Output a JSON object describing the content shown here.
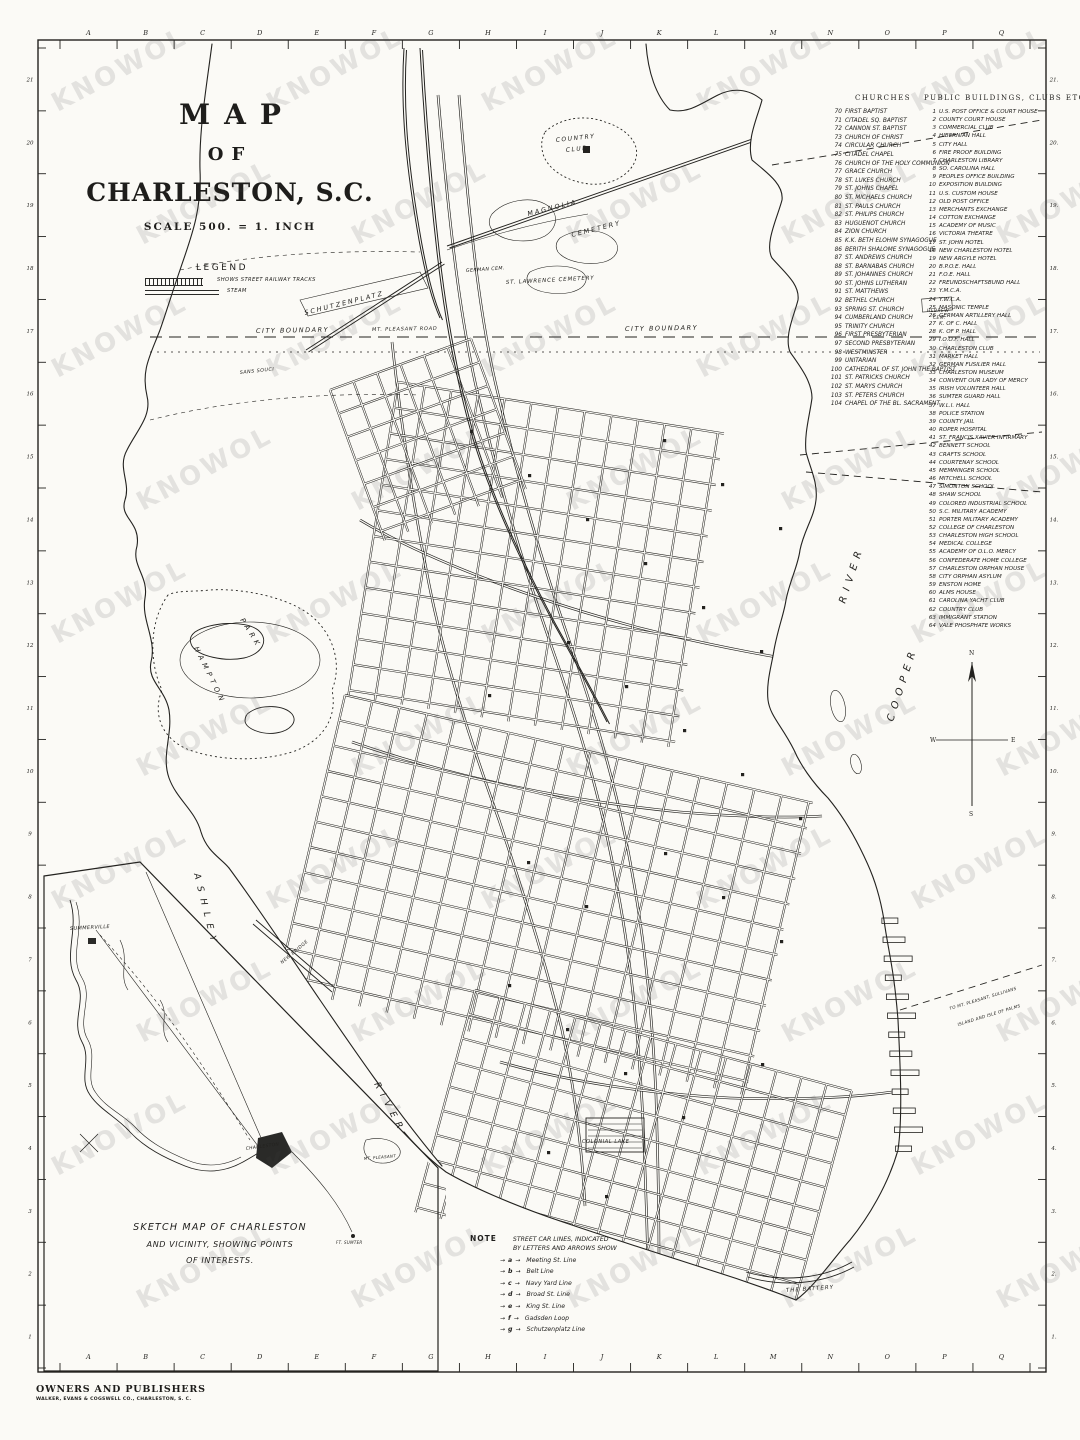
{
  "page": {
    "watermark": "KNOWOL"
  },
  "title": {
    "line1": "MAP",
    "line2": "OF",
    "line3": "CHARLESTON, S.C.",
    "scale": "SCALE 500. = 1. INCH"
  },
  "legend": {
    "heading": "LEGEND",
    "items": [
      {
        "symbol": "hatched-bar",
        "label": "SHOWS STREET RAILWAY TRACKS"
      },
      {
        "symbol": "double-line",
        "label": "STEAM"
      }
    ]
  },
  "ruler": {
    "letters": [
      "A",
      "B",
      "C",
      "D",
      "E",
      "F",
      "G",
      "H",
      "I",
      "J",
      "K",
      "L",
      "M",
      "N",
      "O",
      "P",
      "Q"
    ],
    "left_numbers": [
      "21",
      "20",
      "19",
      "18",
      "17",
      "16",
      "15",
      "14",
      "13",
      "12",
      "11",
      "10",
      "9",
      "8",
      "7",
      "6",
      "5",
      "4",
      "3",
      "2",
      "1"
    ],
    "right_numbers": [
      "21.",
      "20.",
      "19.",
      "18.",
      "17.",
      "16.",
      "15.",
      "14.",
      "13.",
      "12.",
      "11.",
      "10.",
      "9.",
      "8.",
      "7.",
      "6.",
      "5.",
      "4.",
      "3.",
      "2.",
      "1."
    ]
  },
  "churches": {
    "header": "CHURCHES",
    "items": [
      {
        "n": 70,
        "name": "FIRST BAPTIST"
      },
      {
        "n": 71,
        "name": "CITADEL SQ. BAPTIST"
      },
      {
        "n": 72,
        "name": "CANNON ST. BAPTIST"
      },
      {
        "n": 73,
        "name": "CHURCH OF CHRIST"
      },
      {
        "n": 74,
        "name": "CIRCULAR CHURCH"
      },
      {
        "n": 75,
        "name": "CITADEL CHAPEL"
      },
      {
        "n": 76,
        "name": "CHURCH OF THE HOLY COMMUNION"
      },
      {
        "n": 77,
        "name": "GRACE CHURCH"
      },
      {
        "n": 78,
        "name": "ST. LUKES CHURCH"
      },
      {
        "n": 79,
        "name": "ST. JOHNS CHAPEL"
      },
      {
        "n": 80,
        "name": "ST. MICHAELS CHURCH"
      },
      {
        "n": 81,
        "name": "ST. PAULS CHURCH"
      },
      {
        "n": 82,
        "name": "ST. PHILIPS CHURCH"
      },
      {
        "n": 83,
        "name": "HUGUENOT CHURCH"
      },
      {
        "n": 84,
        "name": "ZION CHURCH"
      },
      {
        "n": 85,
        "name": "K.K. BETH ELOHIM SYNAGOGUE"
      },
      {
        "n": 86,
        "name": "BERITH SHALOME SYNAGOGUE"
      },
      {
        "n": 87,
        "name": "ST. ANDREWS CHURCH"
      },
      {
        "n": 88,
        "name": "ST. BARNABAS CHURCH"
      },
      {
        "n": 89,
        "name": "ST. JOHANNES CHURCH"
      },
      {
        "n": 90,
        "name": "ST. JOHNS LUTHERAN"
      },
      {
        "n": 91,
        "name": "ST. MATTHEWS"
      },
      {
        "n": 92,
        "name": "BETHEL CHURCH"
      },
      {
        "n": 93,
        "name": "SPRING ST. CHURCH"
      },
      {
        "n": 94,
        "name": "CUMBERLAND CHURCH"
      },
      {
        "n": 95,
        "name": "TRINITY CHURCH"
      },
      {
        "n": 96,
        "name": "FIRST PRESBYTERIAN"
      },
      {
        "n": 97,
        "name": "SECOND PRESBYTERIAN"
      },
      {
        "n": 98,
        "name": "WESTMINSTER"
      },
      {
        "n": 99,
        "name": "UNITARIAN"
      },
      {
        "n": 100,
        "name": "CATHEDRAL OF ST. JOHN THE BAPTIST"
      },
      {
        "n": 101,
        "name": "ST. PATRICKS CHURCH"
      },
      {
        "n": 102,
        "name": "ST. MARYS CHURCH"
      },
      {
        "n": 103,
        "name": "ST. PETERS CHURCH"
      },
      {
        "n": 104,
        "name": "CHAPEL OF THE BL. SACRAMENT"
      }
    ]
  },
  "buildings": {
    "header": "PUBLIC BUILDINGS, CLUBS ETC.",
    "items": [
      {
        "n": 1,
        "name": "U.S. POST OFFICE & COURT HOUSE"
      },
      {
        "n": 2,
        "name": "COUNTY COURT HOUSE"
      },
      {
        "n": 3,
        "name": "COMMERCIAL CLUB"
      },
      {
        "n": 4,
        "name": "HIBERNIAN HALL"
      },
      {
        "n": 5,
        "name": "CITY HALL"
      },
      {
        "n": 6,
        "name": "FIRE PROOF BUILDING"
      },
      {
        "n": 7,
        "name": "CHARLESTON LIBRARY"
      },
      {
        "n": 8,
        "name": "SO. CAROLINA HALL"
      },
      {
        "n": 9,
        "name": "PEOPLES OFFICE BUILDING"
      },
      {
        "n": 10,
        "name": "EXPOSITION BUILDING"
      },
      {
        "n": 11,
        "name": "U.S. CUSTOM HOUSE"
      },
      {
        "n": 12,
        "name": "OLD POST OFFICE"
      },
      {
        "n": 13,
        "name": "MERCHANTS EXCHANGE"
      },
      {
        "n": 14,
        "name": "COTTON EXCHANGE"
      },
      {
        "n": 15,
        "name": "ACADEMY OF MUSIC"
      },
      {
        "n": 16,
        "name": "VICTORIA THEATRE"
      },
      {
        "n": 17,
        "name": "ST. JOHN HOTEL"
      },
      {
        "n": 18,
        "name": "NEW CHARLESTON HOTEL"
      },
      {
        "n": 19,
        "name": "NEW ARGYLE HOTEL"
      },
      {
        "n": 20,
        "name": "B.P.O.E. HALL"
      },
      {
        "n": 21,
        "name": "F.O.E. HALL"
      },
      {
        "n": 22,
        "name": "FREUNDSCHAFTSBUND HALL"
      },
      {
        "n": 23,
        "name": "Y.M.C.A."
      },
      {
        "n": 24,
        "name": "Y.W.C.A."
      },
      {
        "n": 25,
        "name": "MASONIC TEMPLE"
      },
      {
        "n": 26,
        "name": "GERMAN ARTILLERY HALL"
      },
      {
        "n": 27,
        "name": "K. OF C. HALL"
      },
      {
        "n": 28,
        "name": "K. OF P. HALL"
      },
      {
        "n": 29,
        "name": "I.O.O.F. HALL"
      },
      {
        "n": 30,
        "name": "CHARLESTON CLUB"
      },
      {
        "n": 31,
        "name": "MARKET HALL"
      },
      {
        "n": 32,
        "name": "GERMAN FUSILIER HALL"
      },
      {
        "n": 33,
        "name": "CHARLESTON MUSEUM"
      },
      {
        "n": 34,
        "name": "CONVENT OUR LADY OF MERCY"
      },
      {
        "n": 35,
        "name": "IRISH VOLUNTEER HALL"
      },
      {
        "n": 36,
        "name": "SUMTER GUARD HALL"
      },
      {
        "n": 37,
        "name": "W.L.I. HALL"
      },
      {
        "n": 38,
        "name": "POLICE STATION"
      },
      {
        "n": 39,
        "name": "COUNTY JAIL"
      },
      {
        "n": 40,
        "name": "ROPER HOSPITAL"
      },
      {
        "n": 41,
        "name": "ST. FRANCIS XAVIER INFIRMARY"
      },
      {
        "n": 42,
        "name": "BENNETT SCHOOL"
      },
      {
        "n": 43,
        "name": "CRAFTS SCHOOL"
      },
      {
        "n": 44,
        "name": "COURTENAY SCHOOL"
      },
      {
        "n": 45,
        "name": "MEMMINGER SCHOOL"
      },
      {
        "n": 46,
        "name": "MITCHELL SCHOOL"
      },
      {
        "n": 47,
        "name": "SIMONTON SCHOOL"
      },
      {
        "n": 48,
        "name": "SHAW SCHOOL"
      },
      {
        "n": 49,
        "name": "COLORED INDUSTRIAL SCHOOL"
      },
      {
        "n": 50,
        "name": "S.C. MILITARY ACADEMY"
      },
      {
        "n": 51,
        "name": "PORTER MILITARY ACADEMY"
      },
      {
        "n": 52,
        "name": "COLLEGE OF CHARLESTON"
      },
      {
        "n": 53,
        "name": "CHARLESTON HIGH SCHOOL"
      },
      {
        "n": 54,
        "name": "MEDICAL COLLEGE"
      },
      {
        "n": 55,
        "name": "ACADEMY OF O.L.O. MERCY"
      },
      {
        "n": 56,
        "name": "CONFEDERATE HOME COLLEGE"
      },
      {
        "n": 57,
        "name": "CHARLESTON ORPHAN HOUSE"
      },
      {
        "n": 58,
        "name": "CITY ORPHAN ASYLUM"
      },
      {
        "n": 59,
        "name": "ENSTON HOME"
      },
      {
        "n": 60,
        "name": "ALMS HOUSE"
      },
      {
        "n": 61,
        "name": "CAROLINA YACHT CLUB"
      },
      {
        "n": 62,
        "name": "COUNTRY CLUB"
      },
      {
        "n": 63,
        "name": "IMMIGRANT STATION"
      },
      {
        "n": 64,
        "name": "VALE PHOSPHATE WORKS"
      }
    ]
  },
  "note": {
    "heading": "NOTE",
    "intro1": "STREET CAR LINES, INDICATED",
    "intro2": "BY LETTERS AND ARROWS SHOW",
    "items": [
      {
        "key": "a",
        "label": "Meeting St. Line"
      },
      {
        "key": "b",
        "label": "Belt Line"
      },
      {
        "key": "c",
        "label": "Navy Yard Line"
      },
      {
        "key": "d",
        "label": "Broad St. Line"
      },
      {
        "key": "e",
        "label": "King St. Line"
      },
      {
        "key": "f",
        "label": "Gadsden Loop"
      },
      {
        "key": "g",
        "label": "Schutzenplatz Line"
      }
    ]
  },
  "inset": {
    "caption1": "SKETCH MAP OF CHARLESTON",
    "caption2": "AND VICINITY, SHOWING POINTS",
    "caption3": "OF INTERESTS."
  },
  "publisher": {
    "line1": "OWNERS AND PUBLISHERS",
    "line2": "WALKER, EVANS & COGSWELL CO., CHARLESTON, S. C."
  },
  "compass": {
    "n": "N",
    "s": "S",
    "e": "E",
    "w": "W"
  },
  "map_labels": [
    {
      "name": "label-country-club-1",
      "t": "COUNTRY",
      "x": 556,
      "y": 142,
      "s": 6,
      "r": -6,
      "ls": 1.5
    },
    {
      "name": "label-country-club-2",
      "t": "CLUB",
      "x": 566,
      "y": 152,
      "s": 6,
      "r": -6,
      "ls": 1.5
    },
    {
      "name": "label-magnolia-cemetery-1",
      "t": "MAGNOLIA",
      "x": 528,
      "y": 216,
      "s": 6.5,
      "r": -14,
      "ls": 2
    },
    {
      "name": "label-magnolia-cemetery-2",
      "t": "CEMETERY",
      "x": 572,
      "y": 237,
      "s": 6.5,
      "r": -14,
      "ls": 2
    },
    {
      "name": "label-german-cem",
      "t": "GERMAN CEM.",
      "x": 466,
      "y": 272,
      "s": 4.8,
      "r": -4,
      "ls": 0.4
    },
    {
      "name": "label-st-lawrence-cemetery",
      "t": "ST. LAWRENCE CEMETERY",
      "x": 506,
      "y": 284,
      "s": 5.5,
      "r": -3,
      "ls": 0.8
    },
    {
      "name": "label-hebrew-cem-1",
      "t": "HEBREW",
      "x": 927,
      "y": 312,
      "s": 4.5,
      "r": 0,
      "ls": 0.4
    },
    {
      "name": "label-hebrew-cem-2",
      "t": "CEM.",
      "x": 933,
      "y": 319,
      "s": 4.5,
      "r": 0,
      "ls": 0.4
    },
    {
      "name": "label-schutzenplatz",
      "t": "SCHUTZENPLATZ",
      "x": 305,
      "y": 315,
      "s": 6.5,
      "r": -14,
      "ls": 2
    },
    {
      "name": "label-sans-souci",
      "t": "SANS SOUCI",
      "x": 240,
      "y": 374,
      "s": 4.8,
      "r": -6,
      "ls": 0.5
    },
    {
      "name": "label-city-boundary-left",
      "t": "CITY BOUNDARY",
      "x": 256,
      "y": 333,
      "s": 6.5,
      "r": -1,
      "ls": 1.5
    },
    {
      "name": "label-mt-pleasant-road",
      "t": "MT. PLEASANT ROAD",
      "x": 372,
      "y": 331,
      "s": 5,
      "r": -1,
      "ls": 0.8
    },
    {
      "name": "label-city-boundary-right",
      "t": "CITY BOUNDARY",
      "x": 625,
      "y": 331,
      "s": 6.5,
      "r": -1,
      "ls": 1.5
    },
    {
      "name": "label-hampton",
      "t": "HAMPTON",
      "x": 194,
      "y": 648,
      "s": 7,
      "r": 64,
      "ls": 4
    },
    {
      "name": "label-park",
      "t": "PARK",
      "x": 240,
      "y": 620,
      "s": 7,
      "r": 58,
      "ls": 4
    },
    {
      "name": "label-cooper-river-1",
      "t": "RIVER",
      "x": 845,
      "y": 604,
      "s": 10,
      "r": -72,
      "ls": 6
    },
    {
      "name": "label-cooper-river-2",
      "t": "COOPER",
      "x": 893,
      "y": 722,
      "s": 10,
      "r": -72,
      "ls": 6
    },
    {
      "name": "label-ashley-river-1",
      "t": "ASHLEY",
      "x": 194,
      "y": 874,
      "s": 9,
      "r": 76,
      "ls": 7
    },
    {
      "name": "label-ashley-river-2",
      "t": "RIVER",
      "x": 374,
      "y": 1084,
      "s": 9,
      "r": 62,
      "ls": 6
    },
    {
      "name": "label-new-bridge",
      "t": "NEW BRIDGE",
      "x": 282,
      "y": 964,
      "s": 4.5,
      "r": -40,
      "ls": 0.5
    },
    {
      "name": "label-colonial-lake",
      "t": "COLONIAL LAKE",
      "x": 582,
      "y": 1143,
      "s": 5,
      "r": 0,
      "ls": 0.6
    },
    {
      "name": "label-the-battery",
      "t": "THE BATTERY",
      "x": 786,
      "y": 1292,
      "s": 5.5,
      "r": -4,
      "ls": 1
    },
    {
      "name": "label-ferry-note-1",
      "t": "TO MT. PLEASANT, SULLIVANS",
      "x": 950,
      "y": 1010,
      "s": 4.2,
      "r": -17,
      "ls": 0.3
    },
    {
      "name": "label-ferry-note-2",
      "t": "ISLAND AND ISLE OF PALMS",
      "x": 958,
      "y": 1026,
      "s": 4.2,
      "r": -17,
      "ls": 0.3
    },
    {
      "name": "label-summerville",
      "t": "SUMMERVILLE",
      "x": 70,
      "y": 930,
      "s": 5,
      "r": -3,
      "ls": 0.4
    },
    {
      "name": "label-charleston-inset",
      "t": "CHARLESTON",
      "x": 246,
      "y": 1150,
      "s": 4.5,
      "r": -8,
      "ls": 0.3
    },
    {
      "name": "label-mt-pleasant-inset",
      "t": "MT. PLEASANT",
      "x": 364,
      "y": 1160,
      "s": 4,
      "r": -5,
      "ls": 0.3
    },
    {
      "name": "label-ft-sumter-inset",
      "t": "FT. SUMTER",
      "x": 336,
      "y": 1244,
      "s": 4,
      "r": 0,
      "ls": 0.3
    }
  ]
}
